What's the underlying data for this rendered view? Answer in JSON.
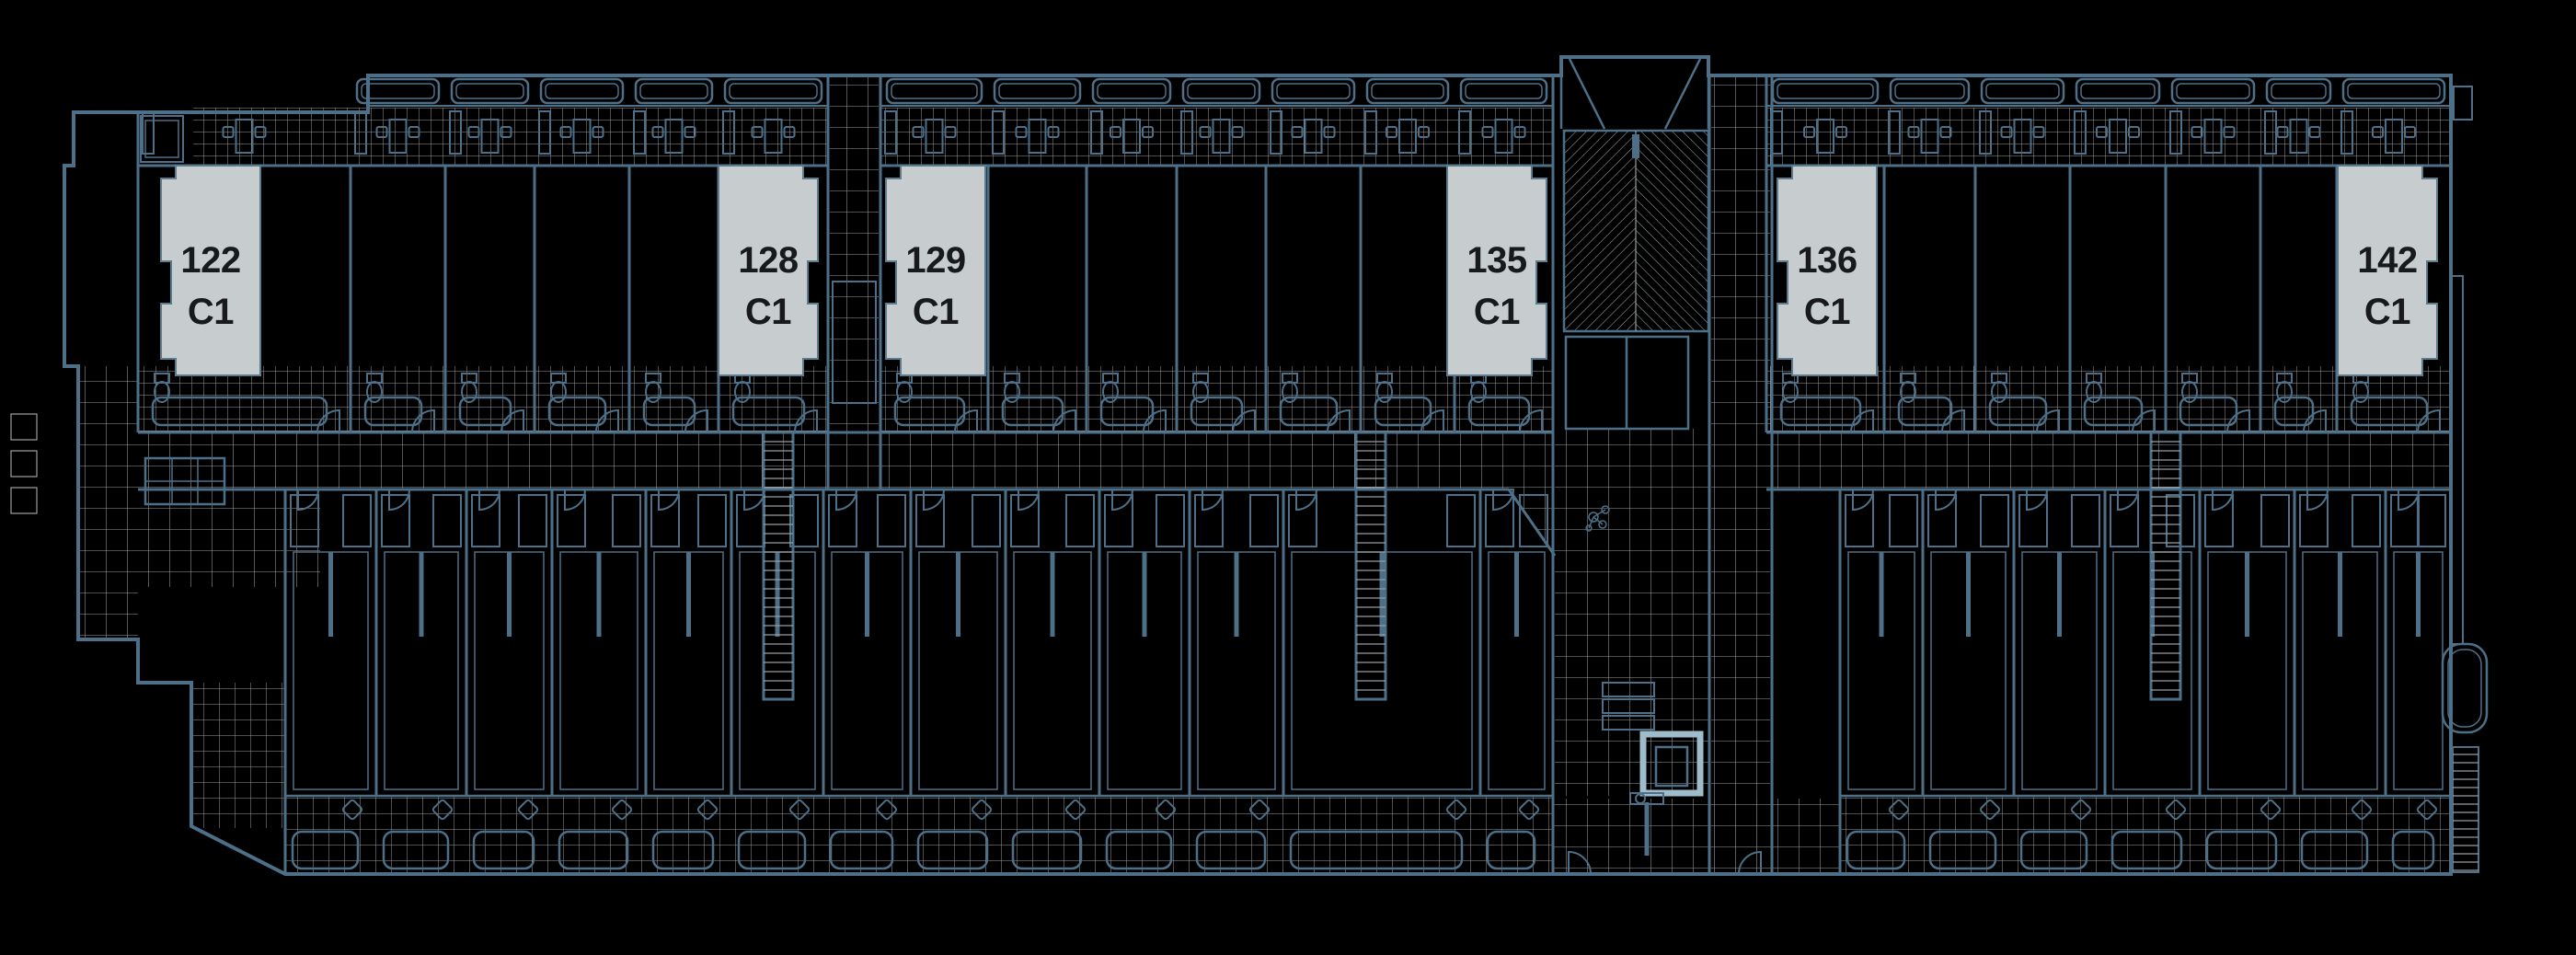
{
  "plan": {
    "description": "building floor plan with unit availability markers",
    "units": [
      {
        "number": "122",
        "type": "C1"
      },
      {
        "number": "128",
        "type": "C1"
      },
      {
        "number": "129",
        "type": "C1"
      },
      {
        "number": "135",
        "type": "C1"
      },
      {
        "number": "136",
        "type": "C1"
      },
      {
        "number": "142",
        "type": "C1"
      }
    ],
    "colors": {
      "background": "#000000",
      "wall_line": "#4d7088",
      "tile_line": "#979da0",
      "hatch_line": "#9aa0a3",
      "unit_label_fill": "#c7cdce",
      "unit_label_border": "#5d7d8e",
      "unit_label_text": "#17191c",
      "elevator_highlight": "#9fbccb"
    },
    "icons": [
      "planter-icon",
      "dining-table-icon",
      "chair-icon",
      "toilet-icon",
      "sofa-icon",
      "door-arc-icon",
      "stair-icon",
      "ladder-stair-icon",
      "elevator-icon",
      "mailboxes-icon",
      "bench-icon",
      "armchair-icon",
      "closet-icon",
      "balcony-icon",
      "light-fixture-icon"
    ]
  }
}
